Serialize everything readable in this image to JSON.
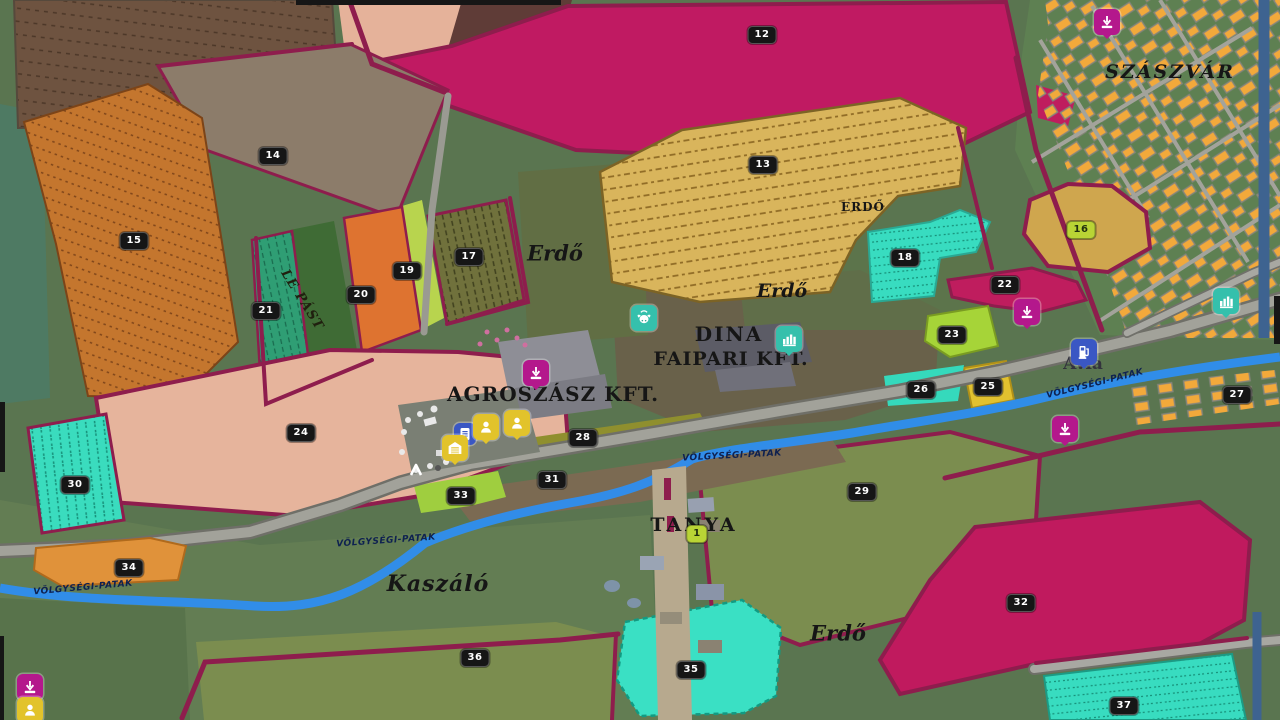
{
  "map_labels": {
    "town": "SZÁSZVÁR",
    "sawmill_line1": "DINA",
    "sawmill_line2": "FAIPARI KFT.",
    "farm_company": "AGROSZÁSZ KFT.",
    "farmstead": "TANYA",
    "meadow": "Kaszáló",
    "pasture": "LE PÁST",
    "fuel_brand": "Avia",
    "forest": [
      "Erdő",
      "ERDŐ",
      "Erdő",
      "Erdő"
    ],
    "stream": "VÖLGYSÉGI-PATAK"
  },
  "fields": [
    {
      "num": "12",
      "owned": false
    },
    {
      "num": "13",
      "owned": false
    },
    {
      "num": "14",
      "owned": false
    },
    {
      "num": "15",
      "owned": false
    },
    {
      "num": "16",
      "owned": true
    },
    {
      "num": "17",
      "owned": false
    },
    {
      "num": "18",
      "owned": false
    },
    {
      "num": "19",
      "owned": false
    },
    {
      "num": "20",
      "owned": false
    },
    {
      "num": "21",
      "owned": false
    },
    {
      "num": "22",
      "owned": false
    },
    {
      "num": "23",
      "owned": false
    },
    {
      "num": "24",
      "owned": false
    },
    {
      "num": "25",
      "owned": false
    },
    {
      "num": "26",
      "owned": false
    },
    {
      "num": "27",
      "owned": false
    },
    {
      "num": "28",
      "owned": false
    },
    {
      "num": "29",
      "owned": false
    },
    {
      "num": "30",
      "owned": false
    },
    {
      "num": "31",
      "owned": false
    },
    {
      "num": "32",
      "owned": false
    },
    {
      "num": "33",
      "owned": false
    },
    {
      "num": "34",
      "owned": false
    },
    {
      "num": "35",
      "owned": false
    },
    {
      "num": "36",
      "owned": false
    },
    {
      "num": "37",
      "owned": false
    },
    {
      "num": "1",
      "owned": true
    }
  ],
  "icons": {
    "sell_point": {
      "name": "sell-point-icon",
      "color": "#b4188c"
    },
    "animal_cow": {
      "name": "cow-icon",
      "color": "#35c0ac"
    },
    "sawmill": {
      "name": "factory-icon",
      "color": "#3cc9b4"
    },
    "fuel": {
      "name": "fuel-icon",
      "color": "#3a57c4"
    },
    "vehicle_shop": {
      "name": "garage-icon",
      "color": "#e2c32b"
    },
    "worker": {
      "name": "person-icon",
      "color": "#e2c32b"
    },
    "player": {
      "name": "player-arrow-icon",
      "color": "#ffffff"
    }
  },
  "colors": {
    "field_border": "#8e1d4d",
    "road": "#a2a29a",
    "stream": "#2e8ef0",
    "houses": "#f2a93b",
    "badge": "#161616",
    "badge_owned": "#b9d435"
  }
}
